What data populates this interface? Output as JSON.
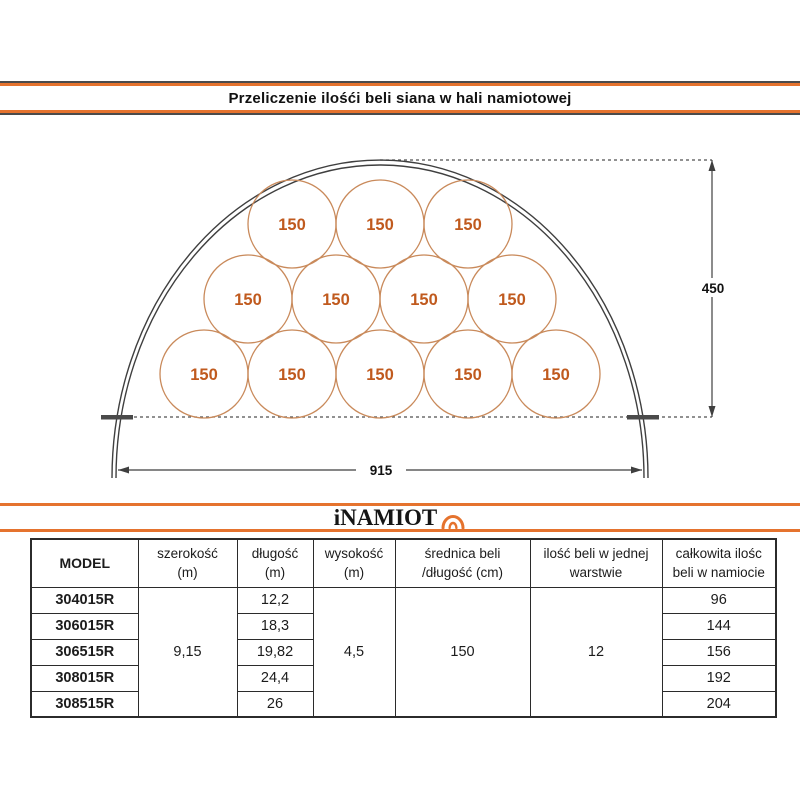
{
  "page": {
    "title": "Przeliczenie ilośći beli siana w hali namiotowej"
  },
  "logo": {
    "text": "iNAMIOT",
    "icon": "tent-arch-icon"
  },
  "diagram": {
    "bale_label": "150",
    "height_label": "450",
    "width_label": "915",
    "bale_rows": [
      3,
      4,
      5
    ],
    "total_bales_shown": 12
  },
  "table": {
    "headers": [
      {
        "l1": "MODEL",
        "l2": ""
      },
      {
        "l1": "szerokość",
        "l2": "(m)"
      },
      {
        "l1": "długość",
        "l2": "(m)"
      },
      {
        "l1": "wysokość",
        "l2": "(m)"
      },
      {
        "l1": "średnica beli",
        "l2": "/długość (cm)"
      },
      {
        "l1": "ilość beli w jednej",
        "l2": "warstwie"
      },
      {
        "l1": "całkowita ilośc",
        "l2": "beli w namiocie"
      }
    ],
    "shared": {
      "szerokosc": "9,15",
      "wysokosc": "4,5",
      "srednica": "150",
      "ilosc_w_warstwie": "12"
    },
    "rows": [
      {
        "model": "304015R",
        "dlugosc": "12,2",
        "total": "96"
      },
      {
        "model": "306015R",
        "dlugosc": "18,3",
        "total": "144"
      },
      {
        "model": "306515R",
        "dlugosc": "19,82",
        "total": "156"
      },
      {
        "model": "308015R",
        "dlugosc": "24,4",
        "total": "192"
      },
      {
        "model": "308515R",
        "dlugosc": "26",
        "total": "204"
      }
    ]
  },
  "colors": {
    "accent_orange": "#e5732e",
    "bale_stroke": "#c98a5b",
    "bale_text": "#c05a1e",
    "line_dark": "#3f3f3f"
  }
}
